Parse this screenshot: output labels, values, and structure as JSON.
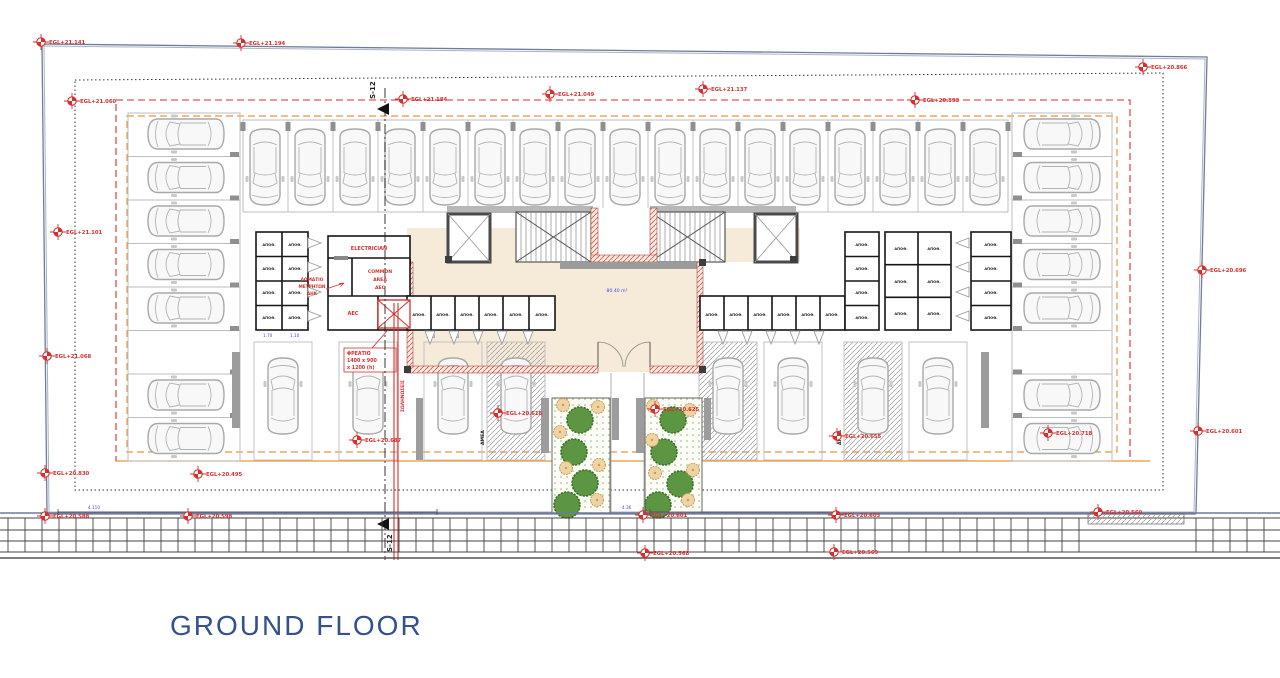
{
  "title": {
    "label": "GROUND FLOOR"
  },
  "colors": {
    "accent_red": "#d62f2f",
    "boundary_blue": "#6f7b99",
    "orange_dashed": "#e8973c",
    "title_blue": "#33508f",
    "lobby_beige": "#f6ead9",
    "tree_green": "#5d9643"
  },
  "plan": {
    "floor_area": "80.40 m²",
    "section_label": "S-12",
    "rooms": {
      "electrician": "ELECTRICIAN",
      "meter_room": {
        "l1": "ΔΩΜΑΤΙΟ",
        "l2": "ΜΕΤΡΗΤΩΝ",
        "l3": "ΑΗΚ"
      },
      "common_area": {
        "l1": "COMMON",
        "l2": "AREA",
        "l3": "AEC"
      },
      "aec": "AEC",
      "storage": "ΑΠΟΘ.",
      "disabled_parking": "ΑΜΕΑ"
    },
    "shaft": {
      "l1": "ΦΡΕΑΤΙΟ",
      "l2": "1400 x 900",
      "l3": "x 1200 (h)"
    },
    "pipe_note": "ΣΩΛΗΝΩΣΕΙΣ",
    "dims": {
      "d1": "4.110",
      "d2": "4.36",
      "c1": "1.70",
      "c2": "1.10",
      "c3": "1.20",
      "c4": "1.40"
    }
  },
  "markers": [
    {
      "label": "EGL+21.141"
    },
    {
      "label": "EGL+21.194"
    },
    {
      "label": "EGL+21.060"
    },
    {
      "label": "EGL+21.184"
    },
    {
      "label": "EGL+21.049"
    },
    {
      "label": "EGL+21.137"
    },
    {
      "label": "EGL+20.893"
    },
    {
      "label": "EGL+20.866"
    },
    {
      "label": "EGL+21.101"
    },
    {
      "label": "EGL+21.068"
    },
    {
      "label": "EGL+20.830"
    },
    {
      "label": "EGL+20.495"
    },
    {
      "label": "EGL+20.588"
    },
    {
      "label": "EGL+20.598"
    },
    {
      "label": "EGL+20.618"
    },
    {
      "label": "EGL+20.625"
    },
    {
      "label": "EGL+20.655"
    },
    {
      "label": "EGL+20.718"
    },
    {
      "label": "EGL+20.601"
    },
    {
      "label": "EGL+20.568"
    },
    {
      "label": "EGL+20.603"
    },
    {
      "label": "EGL+20.569"
    },
    {
      "label": "EGL+20.696"
    },
    {
      "label": "EGL+20.601"
    },
    {
      "label": "EGL+20.687"
    },
    {
      "label": "EGL+20.560"
    }
  ]
}
